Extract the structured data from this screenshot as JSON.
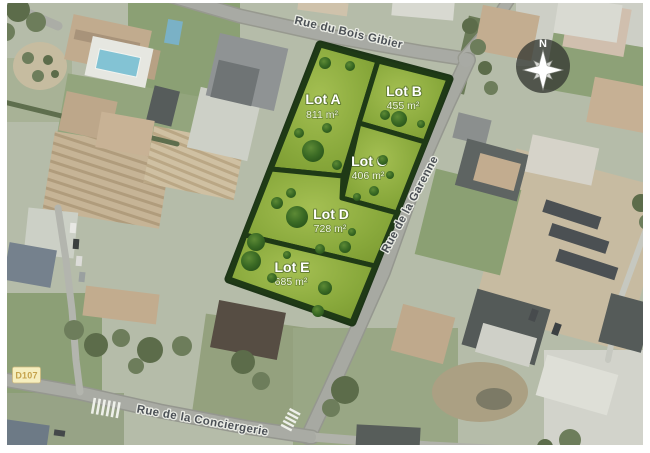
{
  "map": {
    "streets": [
      {
        "name": "Rue du Bois Gibier"
      },
      {
        "name": "Rue de la Garenne"
      },
      {
        "name": "Rue de la Conciergerie"
      }
    ],
    "road_badge": {
      "label": "D107"
    },
    "compass": {
      "north_label": "N"
    },
    "parcel_outline": "320,45 449,79 352,322 229,279",
    "lots": [
      {
        "label": "Lot A",
        "area": "811 m²",
        "points": "320,45 378,61 343,176 271,169"
      },
      {
        "label": "Lot B",
        "area": "455 m²",
        "points": "378,61 449,79 425,142 359,123"
      },
      {
        "label": "Lot C",
        "area": "406 m²",
        "points": "359,123 425,142 397,213 342,198"
      },
      {
        "label": "Lot D",
        "area": "728 m²",
        "points": "271,169 343,176 342,198 397,213 375,266 245,235"
      },
      {
        "label": "Lot E",
        "area": "685 m²",
        "points": "245,235 375,266 352,322 229,279"
      }
    ],
    "lot_trees": [
      {
        "x": 325,
        "y": 63,
        "r": 6
      },
      {
        "x": 350,
        "y": 66,
        "r": 5
      },
      {
        "x": 299,
        "y": 133,
        "r": 5
      },
      {
        "x": 327,
        "y": 128,
        "r": 5
      },
      {
        "x": 313,
        "y": 151,
        "r": 11
      },
      {
        "x": 337,
        "y": 165,
        "r": 5
      },
      {
        "x": 399,
        "y": 119,
        "r": 8
      },
      {
        "x": 385,
        "y": 115,
        "r": 5
      },
      {
        "x": 421,
        "y": 124,
        "r": 4
      },
      {
        "x": 383,
        "y": 160,
        "r": 5
      },
      {
        "x": 374,
        "y": 191,
        "r": 5
      },
      {
        "x": 357,
        "y": 197,
        "r": 4
      },
      {
        "x": 390,
        "y": 175,
        "r": 4
      },
      {
        "x": 291,
        "y": 193,
        "r": 5
      },
      {
        "x": 277,
        "y": 203,
        "r": 6
      },
      {
        "x": 297,
        "y": 217,
        "r": 11
      },
      {
        "x": 320,
        "y": 249,
        "r": 5
      },
      {
        "x": 345,
        "y": 247,
        "r": 6
      },
      {
        "x": 352,
        "y": 232,
        "r": 4
      },
      {
        "x": 256,
        "y": 242,
        "r": 9
      },
      {
        "x": 251,
        "y": 261,
        "r": 10
      },
      {
        "x": 272,
        "y": 278,
        "r": 5
      },
      {
        "x": 325,
        "y": 288,
        "r": 7
      },
      {
        "x": 318,
        "y": 311,
        "r": 6
      },
      {
        "x": 287,
        "y": 255,
        "r": 4
      }
    ],
    "colors": {
      "lot_green": "#8fae3c",
      "lot_border": "#1f3a16",
      "street_label": "#474c52",
      "badge_bg": "#f6eebe",
      "badge_text": "#c5a24b",
      "road": "#a8aaa4"
    }
  }
}
